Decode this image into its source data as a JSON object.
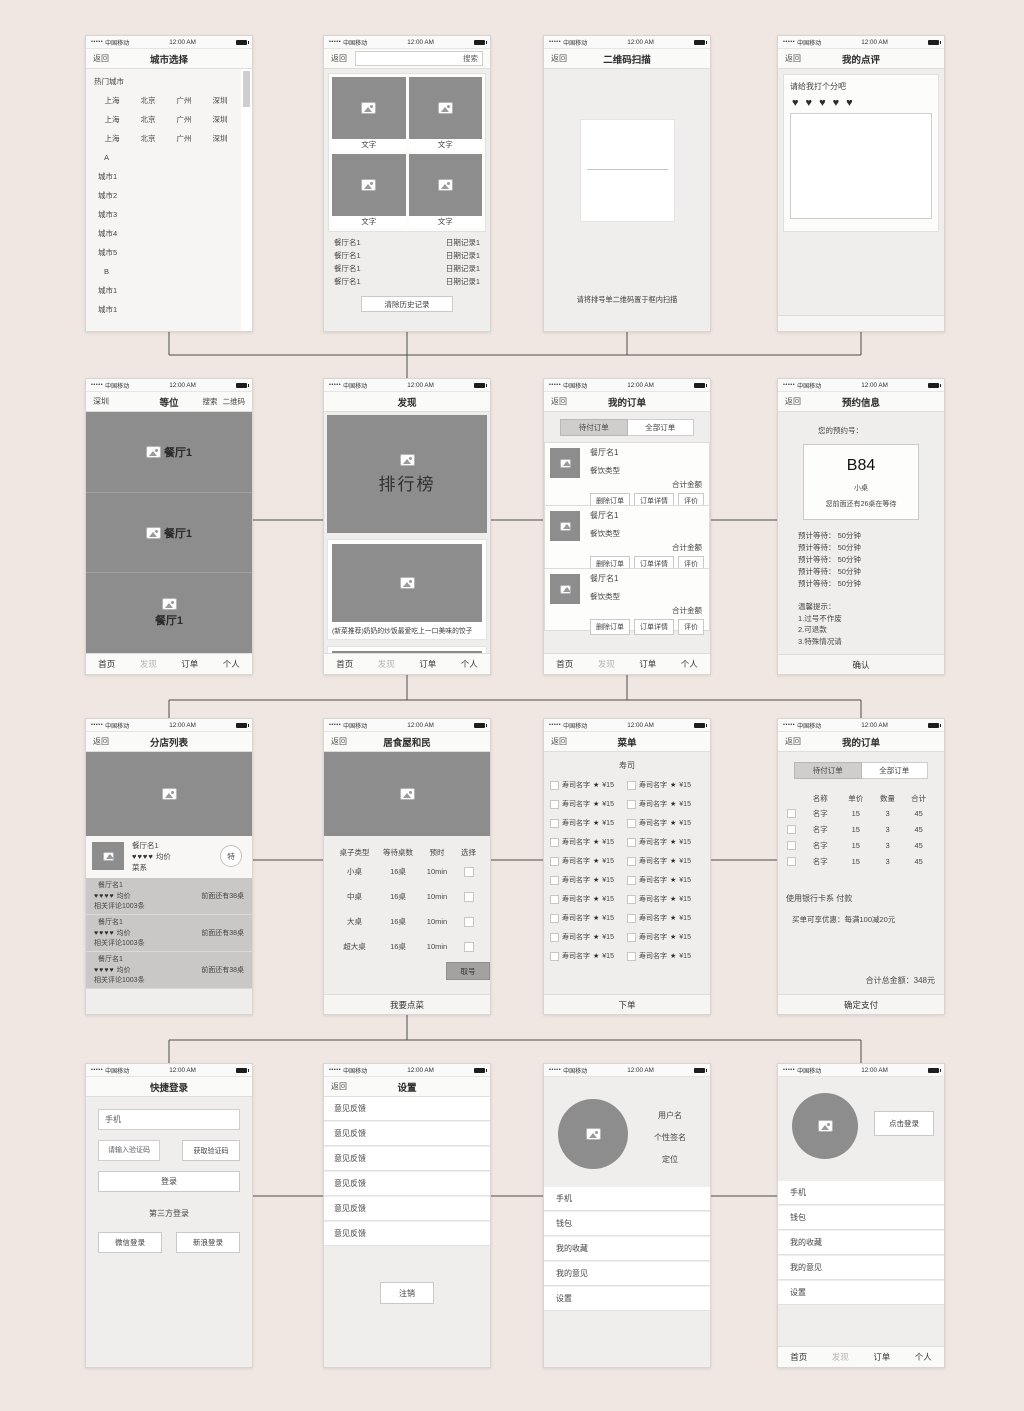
{
  "colors": {
    "canvas": "#f1e7e2",
    "placeholder": "#8e8d8d",
    "connector": "#4c4c4c"
  },
  "status": {
    "signal": "•••••",
    "carrier": "中国移动",
    "time": "12:00 AM"
  },
  "tabs": [
    "首页",
    "发现",
    "订单",
    "个人"
  ],
  "screens": {
    "city_select": {
      "back": "返回",
      "title": "城市选择",
      "hot_label": "热门城市",
      "hot_rows": [
        [
          "上海",
          "北京",
          "广州",
          "深圳"
        ],
        [
          "上海",
          "北京",
          "广州",
          "深圳"
        ],
        [
          "上海",
          "北京",
          "广州",
          "深圳"
        ]
      ],
      "index_a": "A",
      "cities_a": [
        "城市1",
        "城市2",
        "城市3",
        "城市4",
        "城市5"
      ],
      "index_b": "B",
      "cities_b": [
        "城市1",
        "城市1"
      ]
    },
    "search": {
      "back": "返回",
      "placeholder": "搜索",
      "tiles": [
        "文字",
        "文字",
        "文字",
        "文字"
      ],
      "history": [
        {
          "name": "餐厅名1",
          "date": "日期记录1"
        },
        {
          "name": "餐厅名1",
          "date": "日期记录1"
        },
        {
          "name": "餐厅名1",
          "date": "日期记录1"
        },
        {
          "name": "餐厅名1",
          "date": "日期记录1"
        }
      ],
      "clear": "清除历史记录"
    },
    "qr_scan": {
      "back": "返回",
      "title": "二维码扫描",
      "hint": "请将排号单二维码置于框内扫描"
    },
    "review": {
      "back": "返回",
      "title": "我的点评",
      "prompt": "请给我打个分吧",
      "hearts": "♥♥♥♥♥"
    },
    "waiting": {
      "city": "深圳",
      "title": "等位",
      "search": "搜索",
      "qr": "二维码",
      "banners": [
        "餐厅1",
        "餐厅1",
        "餐厅1"
      ]
    },
    "discover": {
      "title": "发现",
      "hero": "排行榜",
      "caption": "(新菜推荐)奶奶的炒饭最爱吃上一口美味的饺子"
    },
    "orders": {
      "back": "返回",
      "title": "我的订单",
      "tab_pending": "待付订单",
      "tab_all": "全部订单",
      "cards": [
        {
          "name": "餐厅名1",
          "type": "餐饮类型",
          "total": "合计金额",
          "b1": "删除订单",
          "b2": "订单详情",
          "b3": "评价"
        },
        {
          "name": "餐厅名1",
          "type": "餐饮类型",
          "total": "合计金额",
          "b1": "删除订单",
          "b2": "订单详情",
          "b3": "评价"
        },
        {
          "name": "餐厅名1",
          "type": "餐饮类型",
          "total": "合计金额",
          "b1": "删除订单",
          "b2": "订单详情",
          "b3": "评价"
        }
      ]
    },
    "reservation": {
      "back": "返回",
      "title": "预约信息",
      "label": "您的预约号：",
      "number": "B84",
      "table_size": "小桌",
      "queue": "您前面还有26桌在等待",
      "waits": [
        "预计等待： 50分钟",
        "预计等待： 50分钟",
        "预计等待： 50分钟",
        "预计等待： 50分钟",
        "预计等待： 50分钟"
      ],
      "tips_title": "温馨提示：",
      "tips": [
        "1.过号不作废",
        "2.可退款",
        "3.特殊情况请"
      ],
      "confirm": "确认"
    },
    "branches": {
      "back": "返回",
      "title": "分店列表",
      "featured": {
        "name": "餐厅名1",
        "hearts": "♥♥♥♥",
        "avg": "均价",
        "cuisine": "菜系",
        "badge": "特"
      },
      "rows": [
        {
          "name": "餐厅名1",
          "hearts": "♥♥♥♥",
          "avg": "均价",
          "comments": "相关评论1003条",
          "queue": "前面还有38桌"
        },
        {
          "name": "餐厅名1",
          "hearts": "♥♥♥♥",
          "avg": "均价",
          "comments": "相关评论1003条",
          "queue": "前面还有38桌"
        },
        {
          "name": "餐厅名1",
          "hearts": "♥♥♥♥",
          "avg": "均价",
          "comments": "相关评论1003条",
          "queue": "前面还有38桌"
        }
      ]
    },
    "restaurant": {
      "back": "返回",
      "title": "居食屋和民",
      "cols": [
        "桌子类型",
        "等待桌数",
        "预时",
        "选择"
      ],
      "rows": [
        {
          "type": "小桌",
          "count": "16桌",
          "time": "10min"
        },
        {
          "type": "中桌",
          "count": "16桌",
          "time": "10min"
        },
        {
          "type": "大桌",
          "count": "16桌",
          "time": "10min"
        },
        {
          "type": "超大桌",
          "count": "16桌",
          "time": "10min"
        }
      ],
      "take": "取号",
      "bottom": "我要点菜"
    },
    "menu": {
      "back": "返回",
      "title": "菜单",
      "section": "寿司",
      "bottom": "下单",
      "items": [
        {
          "name": "寿司名字",
          "star": "★",
          "price": "¥15"
        },
        {
          "name": "寿司名字",
          "star": "★",
          "price": "¥15"
        },
        {
          "name": "寿司名字",
          "star": "★",
          "price": "¥15"
        },
        {
          "name": "寿司名字",
          "star": "★",
          "price": "¥15"
        },
        {
          "name": "寿司名字",
          "star": "★",
          "price": "¥15"
        },
        {
          "name": "寿司名字",
          "star": "★",
          "price": "¥15"
        },
        {
          "name": "寿司名字",
          "star": "★",
          "price": "¥15"
        },
        {
          "name": "寿司名字",
          "star": "★",
          "price": "¥15"
        },
        {
          "name": "寿司名字",
          "star": "★",
          "price": "¥15"
        },
        {
          "name": "寿司名字",
          "star": "★",
          "price": "¥15"
        },
        {
          "name": "寿司名字",
          "star": "★",
          "price": "¥15"
        },
        {
          "name": "寿司名字",
          "star": "★",
          "price": "¥15"
        },
        {
          "name": "寿司名字",
          "star": "★",
          "price": "¥15"
        },
        {
          "name": "寿司名字",
          "star": "★",
          "price": "¥15"
        },
        {
          "name": "寿司名字",
          "star": "★",
          "price": "¥15"
        },
        {
          "name": "寿司名字",
          "star": "★",
          "price": "¥15"
        },
        {
          "name": "寿司名字",
          "star": "★",
          "price": "¥15"
        },
        {
          "name": "寿司名字",
          "star": "★",
          "price": "¥15"
        },
        {
          "name": "寿司名字",
          "star": "★",
          "price": "¥15"
        },
        {
          "name": "寿司名字",
          "star": "★",
          "price": "¥15"
        }
      ]
    },
    "order_detail": {
      "back": "返回",
      "title": "我的订单",
      "tab_pending": "待付订单",
      "tab_all": "全部订单",
      "cols": [
        "名称",
        "单价",
        "数量",
        "合计"
      ],
      "rows": [
        {
          "name": "名字",
          "price": "15",
          "qty": "3",
          "total": "45"
        },
        {
          "name": "名字",
          "price": "15",
          "qty": "3",
          "total": "45"
        },
        {
          "name": "名字",
          "price": "15",
          "qty": "3",
          "total": "45"
        },
        {
          "name": "名字",
          "price": "15",
          "qty": "3",
          "total": "45"
        }
      ],
      "payment": "使用银行卡系 付款",
      "promo": "买单可享优惠：每满100减20元",
      "grand_total": "合计总金额：348元",
      "bottom": "确定支付"
    },
    "login": {
      "title": "快捷登录",
      "phone_placeholder": "手机",
      "code_placeholder": "请输入验证码",
      "get_code": "获取验证码",
      "login_btn": "登录",
      "third": "第三方登录",
      "wechat": "微信登录",
      "weibo": "新浪登录"
    },
    "settings": {
      "back": "返回",
      "title": "设置",
      "items": [
        "意见反馈",
        "意见反馈",
        "意见反馈",
        "意见反馈",
        "意见反馈",
        "意见反馈"
      ],
      "logout": "注销"
    },
    "profile": {
      "username": "用户名",
      "signature": "个性签名",
      "location": "定位",
      "items": [
        "手机",
        "钱包",
        "我的收藏",
        "我的意见",
        "设置"
      ]
    },
    "profile_guest": {
      "login_btn": "点击登录",
      "items": [
        "手机",
        "钱包",
        "我的收藏",
        "我的意见",
        "设置"
      ]
    }
  }
}
